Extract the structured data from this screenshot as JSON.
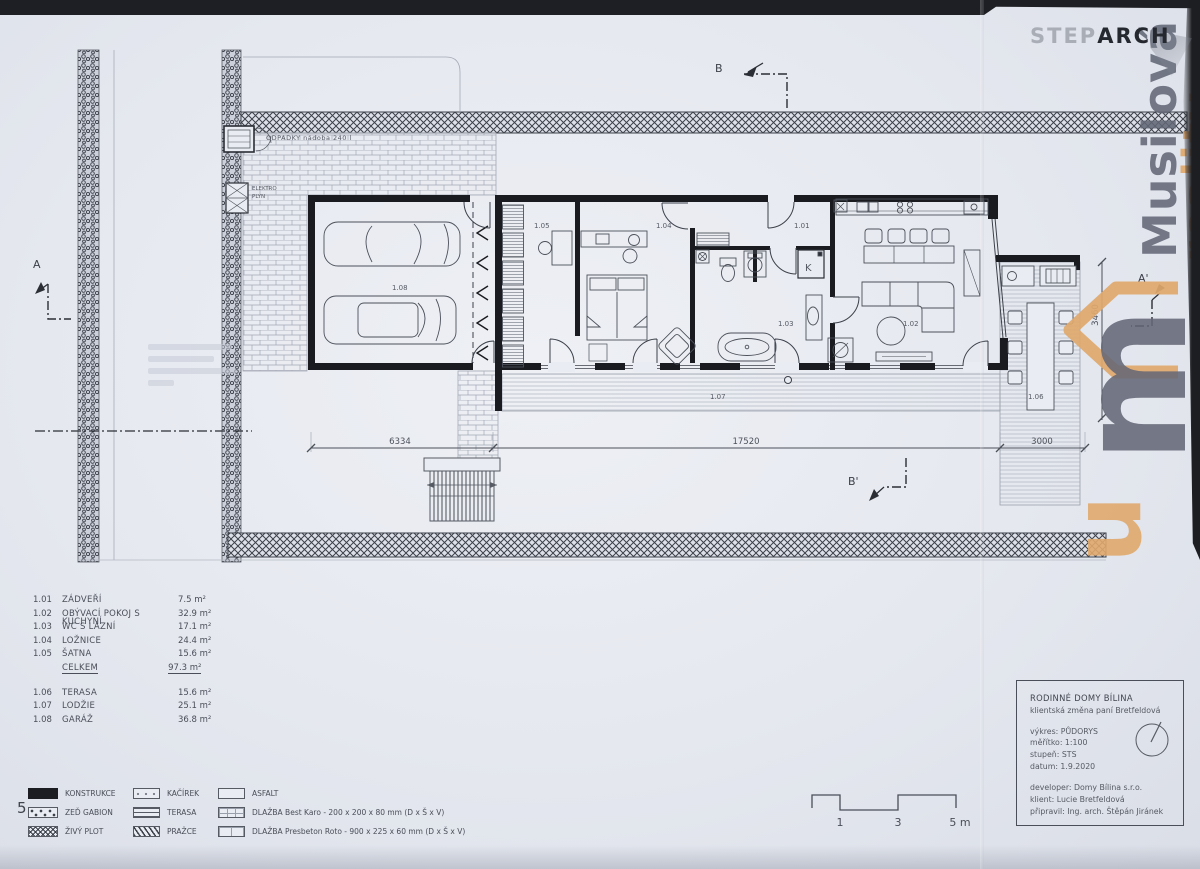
{
  "logo": {
    "step": "STEP",
    "arch": "ARCH"
  },
  "watermark": {
    "name": "Musilová",
    "suffix": "reality",
    "monogram_m": "m",
    "monogram_u": "u",
    "gray": "#62667a",
    "orange": "#e0a86c"
  },
  "plan": {
    "odpadky_label": "ODPADKY  nádoba 240 l",
    "elektro_label": "ELEKTRO",
    "plyn_label": "PLYN",
    "boiler": "K",
    "sections": {
      "a": "A",
      "a2": "A'",
      "b": "B",
      "b2": "B'"
    },
    "rooms": {
      "r101": "1.01",
      "r102": "1.02",
      "r103": "1.03",
      "r104": "1.04",
      "r105": "1.05",
      "r106": "1.06",
      "r107": "1.07",
      "r108": "1.08"
    },
    "dims": {
      "d1": "6334",
      "d2": "17520",
      "d3": "3000",
      "v1": "3460"
    }
  },
  "room_legend": {
    "rows": [
      {
        "code": "1.01",
        "name": "ZÁDVEŘÍ",
        "area": "7.5 m²"
      },
      {
        "code": "1.02",
        "name": "OBÝVACÍ POKOJ S KUCHYNÍ",
        "area": "32.9 m²"
      },
      {
        "code": "1.03",
        "name": "WC S LÁZNÍ",
        "area": "17.1 m²"
      },
      {
        "code": "1.04",
        "name": "LOŽNICE",
        "area": "24.4 m²"
      },
      {
        "code": "1.05",
        "name": "ŠATNA",
        "area": "15.6 m²"
      },
      {
        "code": "",
        "name": "CELKEM",
        "area": "97.3 m²"
      },
      {
        "code": "1.06",
        "name": "TERASA",
        "area": "15.6 m²"
      },
      {
        "code": "1.07",
        "name": "LODŽIE",
        "area": "25.1 m²"
      },
      {
        "code": "1.08",
        "name": "GARÁŽ",
        "area": "36.8 m²"
      }
    ]
  },
  "material_legend": {
    "page_number": "5",
    "items": [
      {
        "label": "KONSTRUKCE"
      },
      {
        "label": "ZEĎ GABION"
      },
      {
        "label": "ŽIVÝ PLOT"
      },
      {
        "label": "KAČÍREK"
      },
      {
        "label": "TERASA"
      },
      {
        "label": "PRAŽCE"
      },
      {
        "label": "ASFALT"
      },
      {
        "label": "DLAŽBA Best Karo - 200 x 200 x 80 mm (D x Š x V)"
      },
      {
        "label": "DLAŽBA Presbeton Roto - 900 x 225 x 60 mm (D x Š x V)"
      }
    ]
  },
  "scale_bar": {
    "t1": "1",
    "t2": "3",
    "t3": "5 m"
  },
  "title_block": {
    "project": "RODINNÉ DOMY BÍLINA",
    "subtitle": "klientská změna paní Bretfeldová",
    "drawing": "výkres: PŮDORYS",
    "scale": "měřítko: 1:100",
    "stage": "stupeň: STS",
    "date": "datum: 1.9.2020",
    "developer": "developer: Domy Bílina s.r.o.",
    "client": "klient: Lucie Bretfeldová",
    "prepared": "připravil: Ing. arch. Štěpán Jiránek"
  }
}
